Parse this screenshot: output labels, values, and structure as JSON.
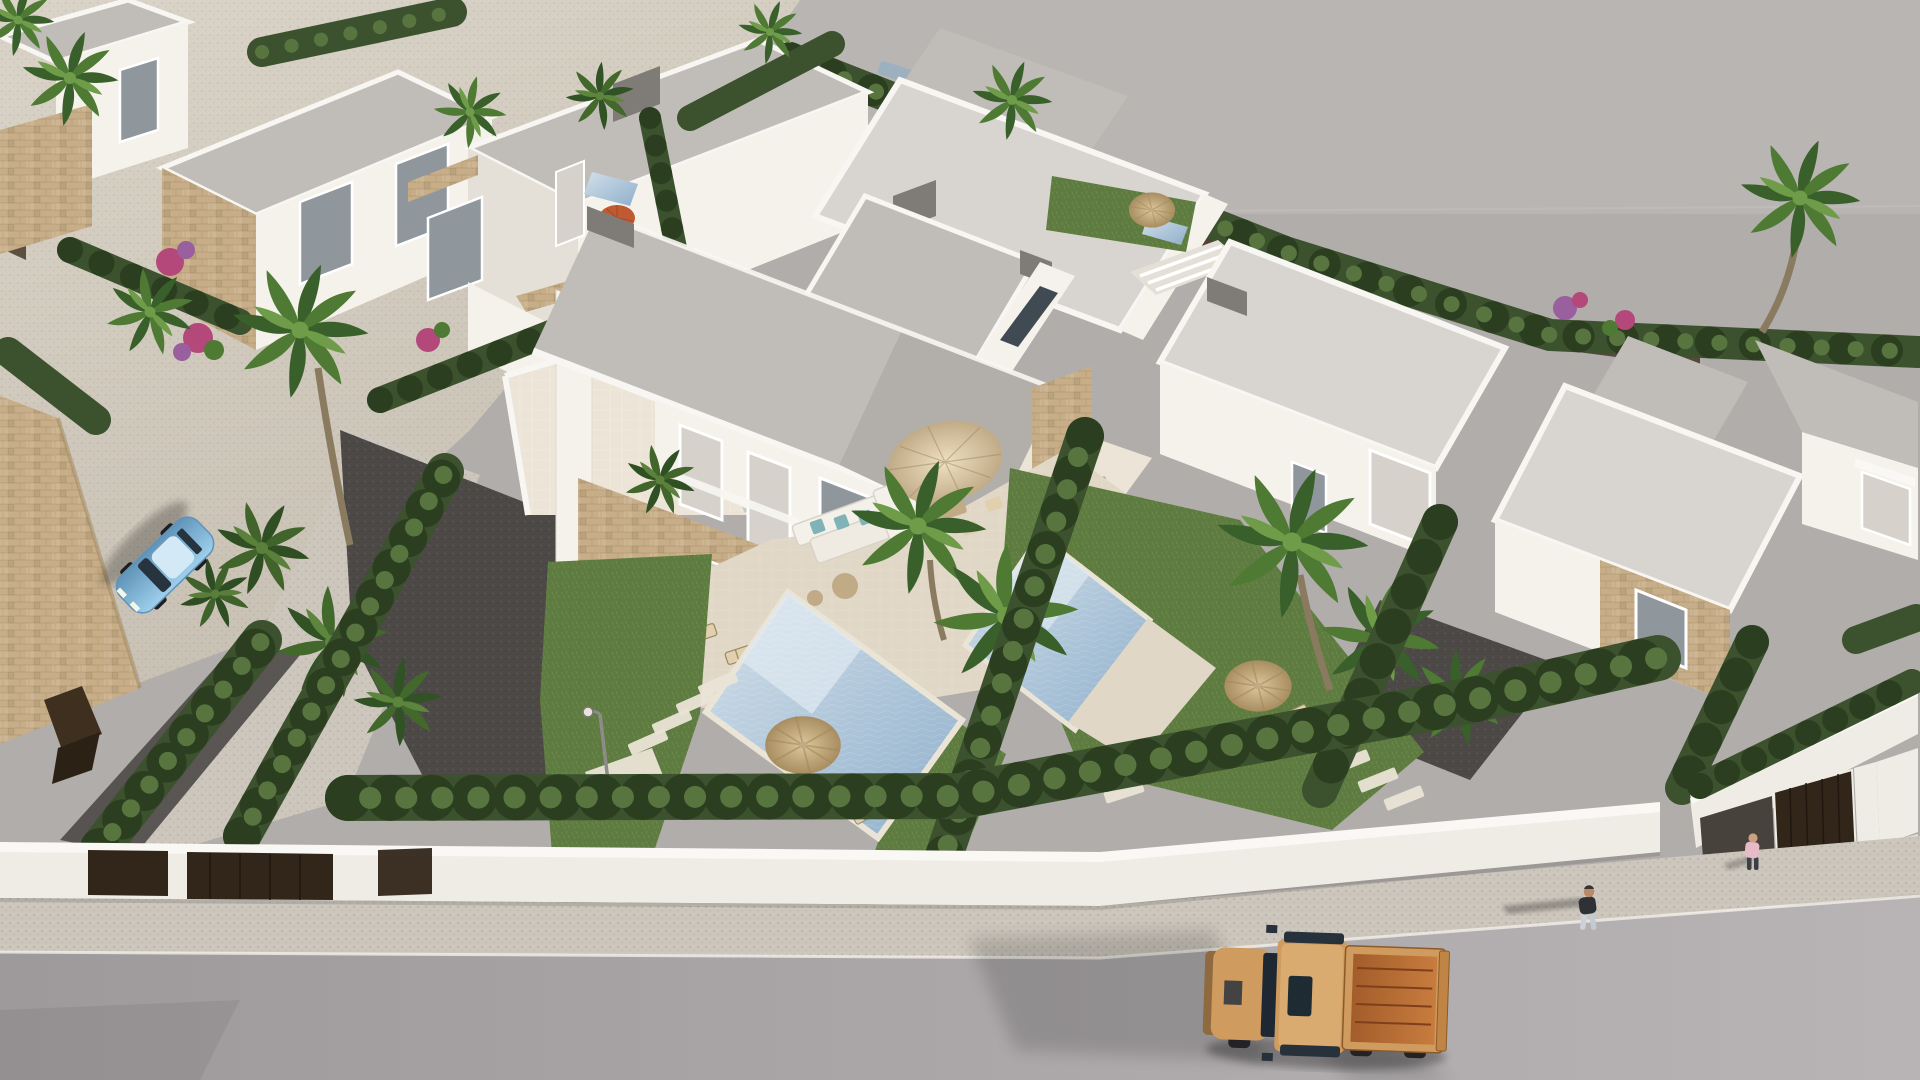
{
  "meta": {
    "title": "Aerial 3D architectural render of a modern white villa development",
    "description": "Bird's-eye computer rendering of rows of flat-roofed white villas with stone-clad accents, private pools, green hedges, palm trees, a front boundary wall, a sidewalk and street with an orange pickup truck, a light-blue parked car and two pedestrians.",
    "type": "3d-architectural-render",
    "text_content": "none"
  },
  "colors": {
    "ground": "#b1adab",
    "groundLight": "#bcb8b5",
    "horizon": "#c6c2be",
    "sand": "#dad3c7",
    "sandShade": "#c6bfb2",
    "roadDark": "#9e9a9c",
    "roadLight": "#b8b4b6",
    "sidewalk": "#ccc6bc",
    "curb": "#f2efe9",
    "wallWhite": "#efece6",
    "wallTop": "#faf8f4",
    "villaWhite": "#f5f2ec",
    "villaShade": "#e5e0d7",
    "roof": "#c0bdb8",
    "roofLight": "#d8d5d0",
    "roofDark": "#b2afaa",
    "parapet": "#f8f6f2",
    "chimney": "#7f7c78",
    "stone": "#c7ae88",
    "stoneDark": "#a08659",
    "glass": "#8f969c",
    "glassDark": "#3f4a52",
    "curtain": "#d6d2cb",
    "frame": "#ffffff",
    "hedge": "#3c512d",
    "hedgeDark": "#2c3e20",
    "hedgeLight": "#587540",
    "grass": "#5e7c41",
    "gravel": "#4c4947",
    "pool1": "#d3e0ea",
    "pool2": "#8fafcb",
    "poolStep": "#dde8f0",
    "coping": "#eae4d6",
    "terrace": "#e0d7c6",
    "terraceLight": "#ece5d7",
    "strawLight": "#dcc79c",
    "strawDark": "#a88d60",
    "fabricLight": "#eee0c2",
    "fabric": "#e0d0ae",
    "fabricDark": "#c1ab87",
    "parasolRed": "#c05a33",
    "truck": "#d09b5e",
    "truckBed": "#a35d2b",
    "truckCopper": "#c87c3e",
    "carBlue": "#9ed0ec",
    "carBlueDark": "#5f93b8",
    "gate": "#32261a",
    "corten": "#3f2f1f",
    "teal": "#7fb3b8",
    "magenta": "#b5487a",
    "purple": "#9a5f9e",
    "leaf": "#4e7a33",
    "leafDark": "#39602a",
    "leafLight": "#6f9c49",
    "trunk": "#8a7a5f",
    "skin": "#c09878"
  },
  "scene": {
    "objects": [
      "rows of white flat-roof villas with stone-clad accents",
      "hero duplex villa with two-storey glazed facade and curtains",
      "roof terrace with travertine floor and stone coping",
      "two private swimming pools with tan coping",
      "lawns, dark gravel yards and stepping stones",
      "boundary hedges and perimeter wall with corten gates",
      "palm trees, banana plants and bougainvillea",
      "straw garden parasols, beige dining parasol, sun loungers, outdoor sofa with teal cushions",
      "street lamp",
      "orange pickup truck on the street",
      "light blue parked car",
      "two pedestrians on the sidewalk",
      "garage with brown door and driveway ramp at right"
    ],
    "vehicles": {
      "pickup_truck_color": "orange-tan",
      "parked_car_color": "light blue"
    },
    "people_count": 2
  }
}
